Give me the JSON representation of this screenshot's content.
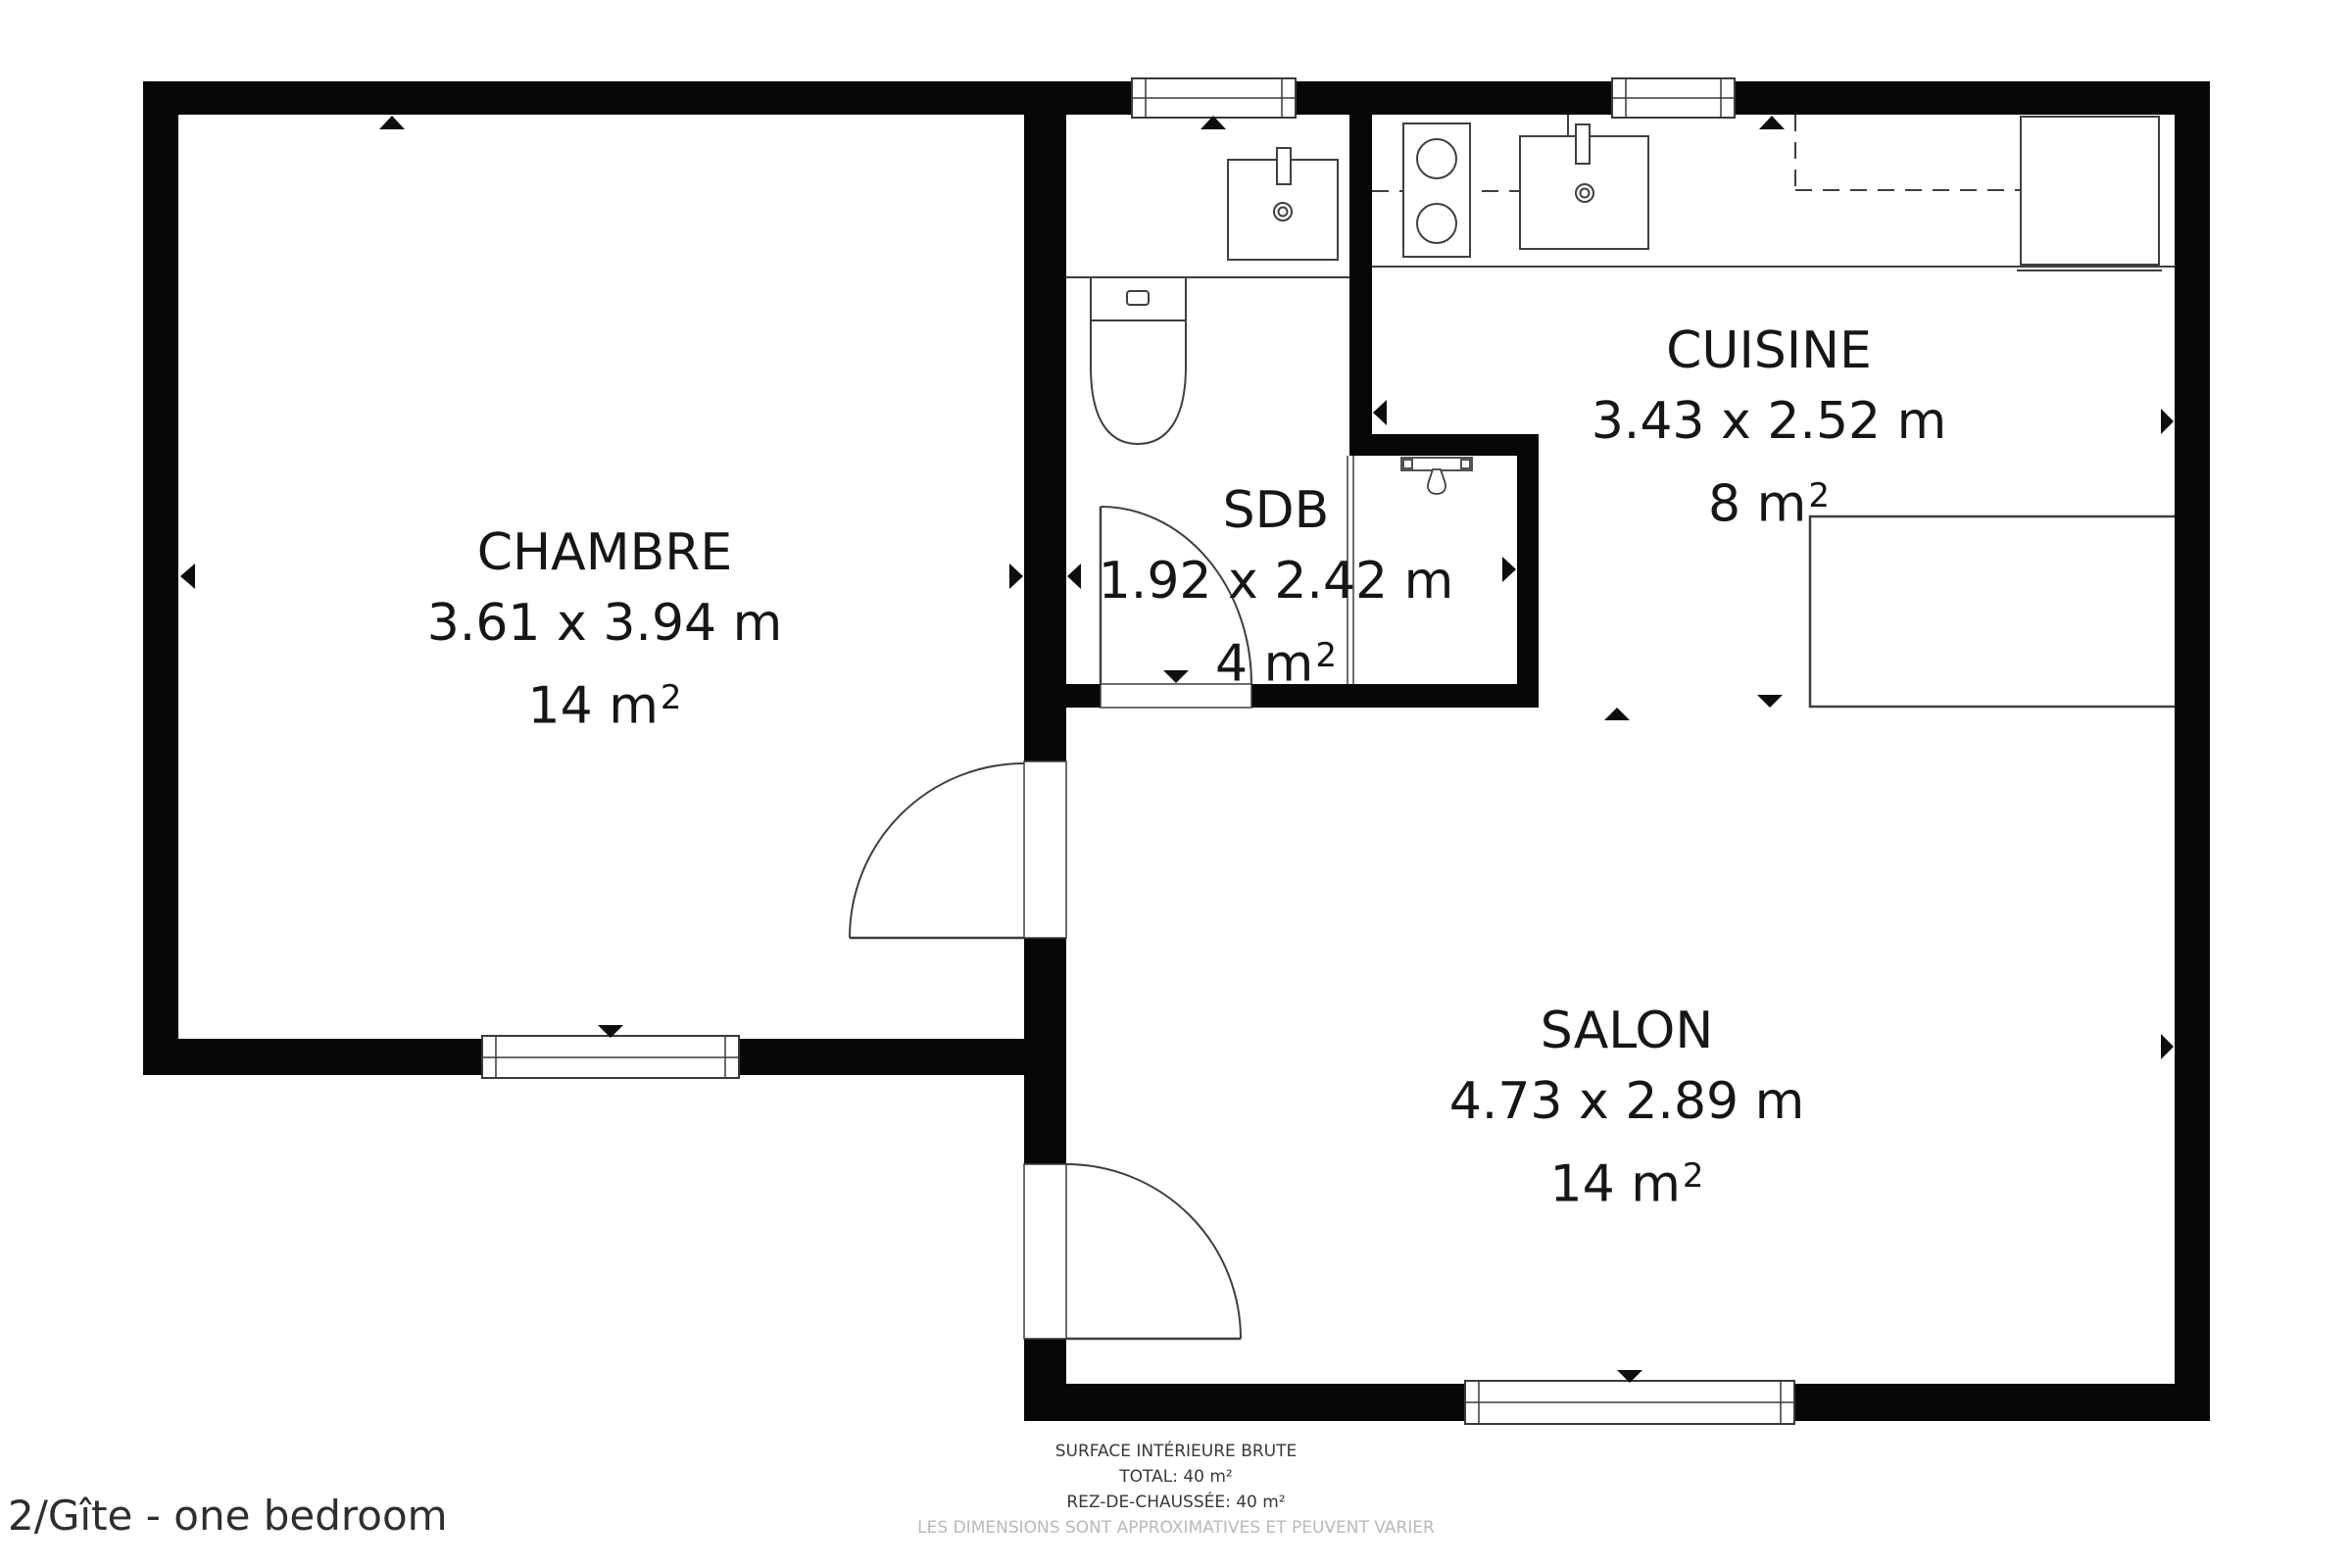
{
  "title": "2/Gîte - one bedroom",
  "rooms": {
    "chambre": {
      "name": "CHAMBRE",
      "dimensions": "3.61 x 3.94 m",
      "area": "14 m",
      "area_sup": "2"
    },
    "sdb": {
      "name": "SDB",
      "dimensions": "1.92 x 2.42 m",
      "area": "4 m",
      "area_sup": "2"
    },
    "cuisine": {
      "name": "CUISINE",
      "dimensions": "3.43 x 2.52 m",
      "area": "8 m",
      "area_sup": "2"
    },
    "salon": {
      "name": "SALON",
      "dimensions": "4.73 x 2.89 m",
      "area": "14 m",
      "area_sup": "2"
    }
  },
  "footer": {
    "line1": "SURFACE INTÉRIEURE BRUTE",
    "line2": "TOTAL: 40 m²",
    "line3": "REZ-DE-CHAUSSÉE: 40 m²",
    "line4": "LES DIMENSIONS SONT APPROXIMATIVES ET PEUVENT VARIER"
  },
  "colors": {
    "wall": "#070707",
    "fixture_stroke": "#3f3f3f",
    "text": "#161616",
    "muted_text": "#b9b9b9"
  },
  "icons": {
    "wall-marker-icon": "small solid black triangle (▲ ▼ ◀ ▶) attached to walls",
    "window-icon": "white double-line rectangle crossing wall",
    "door-swing-icon": "quarter-circle arc with door leaf line",
    "toilet-icon": "cistern rectangle with button + U-shaped bowl",
    "sink-icon": "square basin with tap stub and double-circle drain",
    "stove-icon": "rectangle with two burner circles",
    "fridge-icon": "rectangle at counter end",
    "shower-icon": "rail bar with hanging sprayer droplet",
    "table-icon": "large rectangle outline",
    "cabinet-dashed-icon": "dashed line for overhead cabinets"
  }
}
